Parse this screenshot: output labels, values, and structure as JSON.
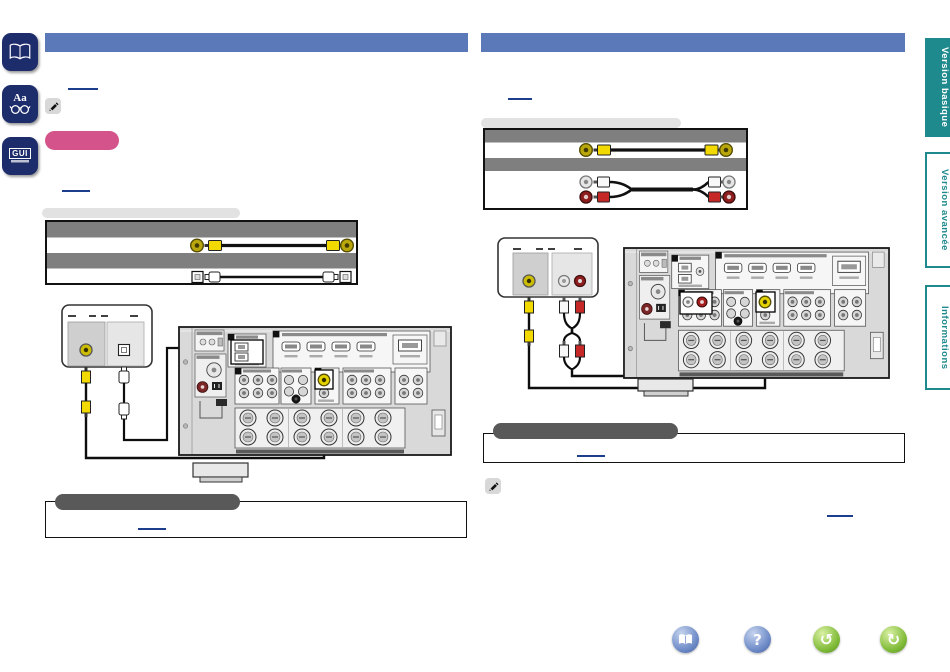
{
  "window": {
    "width": 950,
    "height": 672,
    "background": "#ffffff"
  },
  "left_toolbar": {
    "button_color": "#1d2c6b",
    "buttons": [
      {
        "id": "manual-pages",
        "icon": "open-book-icon",
        "label": ""
      },
      {
        "id": "text-lookup",
        "icon": "reading-glasses-icon",
        "label": "Aa"
      },
      {
        "id": "gui-guide",
        "icon": "gui-icon",
        "label": "GUI"
      }
    ]
  },
  "side_tabs": {
    "accent_color": "#1f8a8e",
    "items": [
      {
        "label": "Version basique",
        "active": true
      },
      {
        "label": "Version avancée",
        "active": false
      },
      {
        "label": "Informations",
        "active": false
      }
    ]
  },
  "bottom_nav": {
    "blue_color": "#6f8cc8",
    "green_color": "#82bc3a",
    "buttons": [
      {
        "id": "contents",
        "icon": "open-book-icon",
        "glyph": ""
      },
      {
        "id": "help",
        "icon": "question-mark-icon",
        "glyph": "?"
      },
      {
        "id": "back",
        "icon": "rotate-left-arrow-icon",
        "glyph": "↺"
      },
      {
        "id": "forward",
        "icon": "rotate-right-arrow-icon",
        "glyph": "↻"
      }
    ]
  },
  "content": {
    "header_bar_color": "#5b79b8",
    "pink_badge_color": "#d4538a",
    "note_pill_color": "#595959",
    "link_color": "#1c3e8c",
    "gray_band_color": "#7f7f7f",
    "rca_colors": {
      "video": "#f2da00",
      "audio_left": "#f2f2f2",
      "audio_right": "#c62828"
    }
  }
}
